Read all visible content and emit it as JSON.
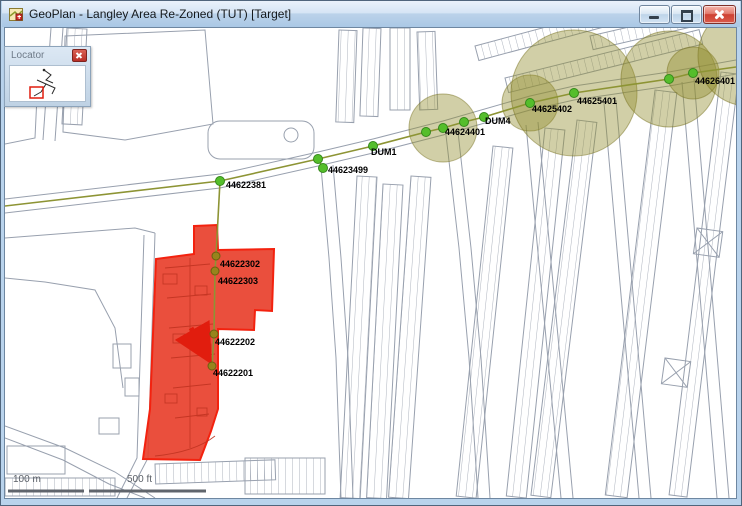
{
  "window": {
    "title": "GeoPlan - Langley Area Re-Zoned (TUT) [Target]"
  },
  "locator": {
    "title": "Locator"
  },
  "map": {
    "node_labels": [
      {
        "text": "44622381"
      },
      {
        "text": "44623499"
      },
      {
        "text": "DUM1"
      },
      {
        "text": "44624401"
      },
      {
        "text": "DUM4"
      },
      {
        "text": "44625402"
      },
      {
        "text": "44625401"
      },
      {
        "text": "44626401"
      },
      {
        "text": "44622302"
      },
      {
        "text": "44622303"
      },
      {
        "text": "44622202"
      },
      {
        "text": "44622201"
      }
    ],
    "scale_bar": {
      "metric": "100 m",
      "imperial": "500 ft"
    },
    "colors": {
      "rezoned_fill": "#e8402c",
      "rezoned_border": "#f3220f",
      "demand_circle": "#928c2d",
      "node_green": "#55be2b",
      "node_olive": "#97841c",
      "arrow_red": "#e11d0e",
      "street_gray": "#98a0ae"
    }
  }
}
